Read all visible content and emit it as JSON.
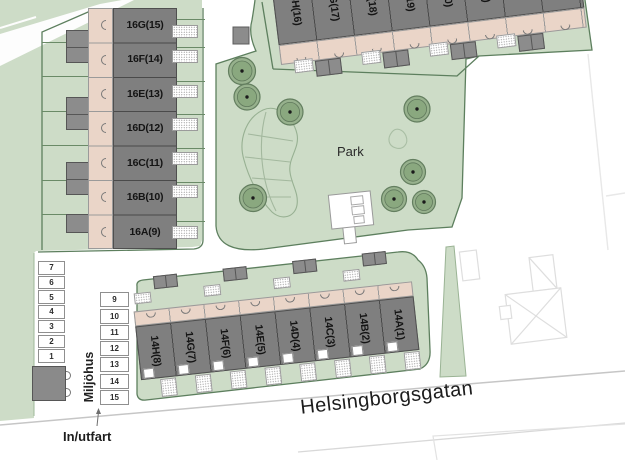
{
  "left_block": {
    "units": [
      "16G(15)",
      "16F(14)",
      "16E(13)",
      "16D(12)",
      "16C(11)",
      "16B(10)",
      "16A(9)"
    ]
  },
  "top_block": {
    "units": [
      "15H(16)",
      "15G(17)",
      "15F(18)",
      "15E(19)",
      "15D(20)",
      "15C(21)",
      "15B(22)",
      "15A(23)"
    ]
  },
  "bottom_block": {
    "units": [
      "14H(8)",
      "14G(7)",
      "14F(6)",
      "14E(5)",
      "14D(4)",
      "14C(3)",
      "14B(2)",
      "14A(1)"
    ]
  },
  "parking": {
    "west_column": [
      "7",
      "6",
      "5",
      "4",
      "3",
      "2",
      "1"
    ],
    "east_column": [
      "9",
      "10",
      "11",
      "12",
      "13",
      "14",
      "15"
    ]
  },
  "labels": {
    "park": "Park",
    "street": "Helsingborgsgatan",
    "waste_house": "Miljöhus",
    "entrance": "In/utfart"
  },
  "colors": {
    "site_green": "#cddcc7",
    "building_gray": "#7f7f7f",
    "shed_gray": "#8c8c8c",
    "entry_beige": "#ead5c8",
    "border_green": "#5d7f5e",
    "tree_green": "#8aa87f"
  }
}
